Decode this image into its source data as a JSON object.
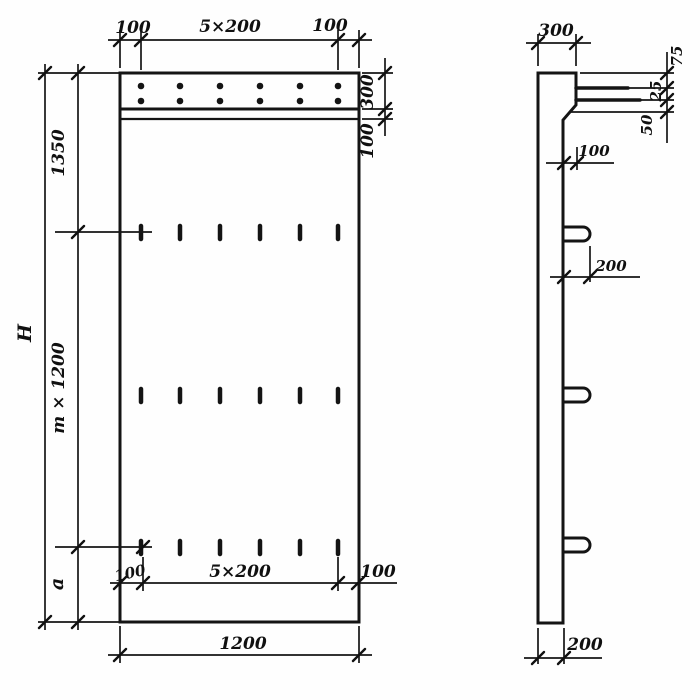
{
  "front_view": {
    "top_dim": {
      "left": "100",
      "span": "5×200",
      "right": "100"
    },
    "right_dim": {
      "band": "300",
      "strip": "100"
    },
    "left_dim": {
      "overall": "H",
      "top": "1350",
      "middle": "m × 1200",
      "bottom": "a"
    },
    "inner_bottom_dim": {
      "left": "100",
      "span": "5×200",
      "right": "100"
    },
    "bottom_dim": {
      "width": "1200"
    }
  },
  "side_view": {
    "top_dim": {
      "width": "300"
    },
    "right_dim": {
      "top": "75",
      "middle": "25",
      "bottom": "50"
    },
    "ledge_dim": {
      "offset": "100"
    },
    "hook_dim": {
      "length": "200"
    },
    "bottom_dim": {
      "thickness": "200"
    }
  },
  "colors": {
    "ink": "#141414",
    "paper": "#fefefe"
  }
}
